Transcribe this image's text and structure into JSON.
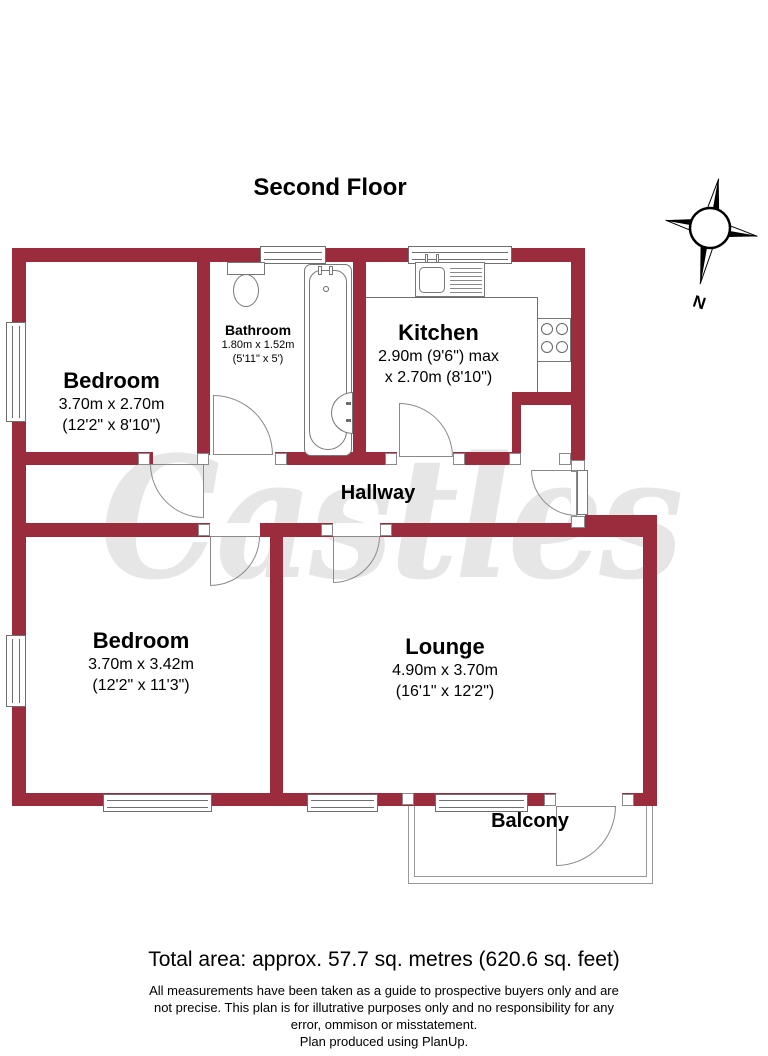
{
  "title": "Second Floor",
  "watermark": "Castles",
  "compass": {
    "label": "N"
  },
  "rooms": [
    {
      "id": "bedroom1",
      "name": "Bedroom",
      "dim1": "3.70m x 2.70m",
      "dim2": "(12'2\" x 8'10\")"
    },
    {
      "id": "bathroom",
      "name": "Bathroom",
      "dim1": "1.80m x 1.52m",
      "dim2": "(5'11\" x 5')"
    },
    {
      "id": "kitchen",
      "name": "Kitchen",
      "dim1": "2.90m (9'6\") max",
      "dim2": "x 2.70m (8'10\")"
    },
    {
      "id": "hallway",
      "name": "Hallway"
    },
    {
      "id": "bedroom2",
      "name": "Bedroom",
      "dim1": "3.70m x 3.42m",
      "dim2": "(12'2\" x 11'3\")"
    },
    {
      "id": "lounge",
      "name": "Lounge",
      "dim1": "4.90m x 3.70m",
      "dim2": "(16'1\" x 12'2\")"
    },
    {
      "id": "balcony",
      "name": "Balcony"
    }
  ],
  "footer": {
    "total_area": "Total area: approx. 57.7 sq. metres (620.6 sq. feet)",
    "disclaimer_line1": "All measurements have been taken as a guide to prospective buyers only and are",
    "disclaimer_line2": "not precise. This plan is for illutrative purposes only and no responsibility for any",
    "disclaimer_line3": "error, ommison or misstatement.",
    "disclaimer_line4": "Plan produced using PlanUp."
  },
  "colors": {
    "wall": "#9b2c3e",
    "line": "#6e6e6e",
    "watermark": "#e6e6e6"
  }
}
